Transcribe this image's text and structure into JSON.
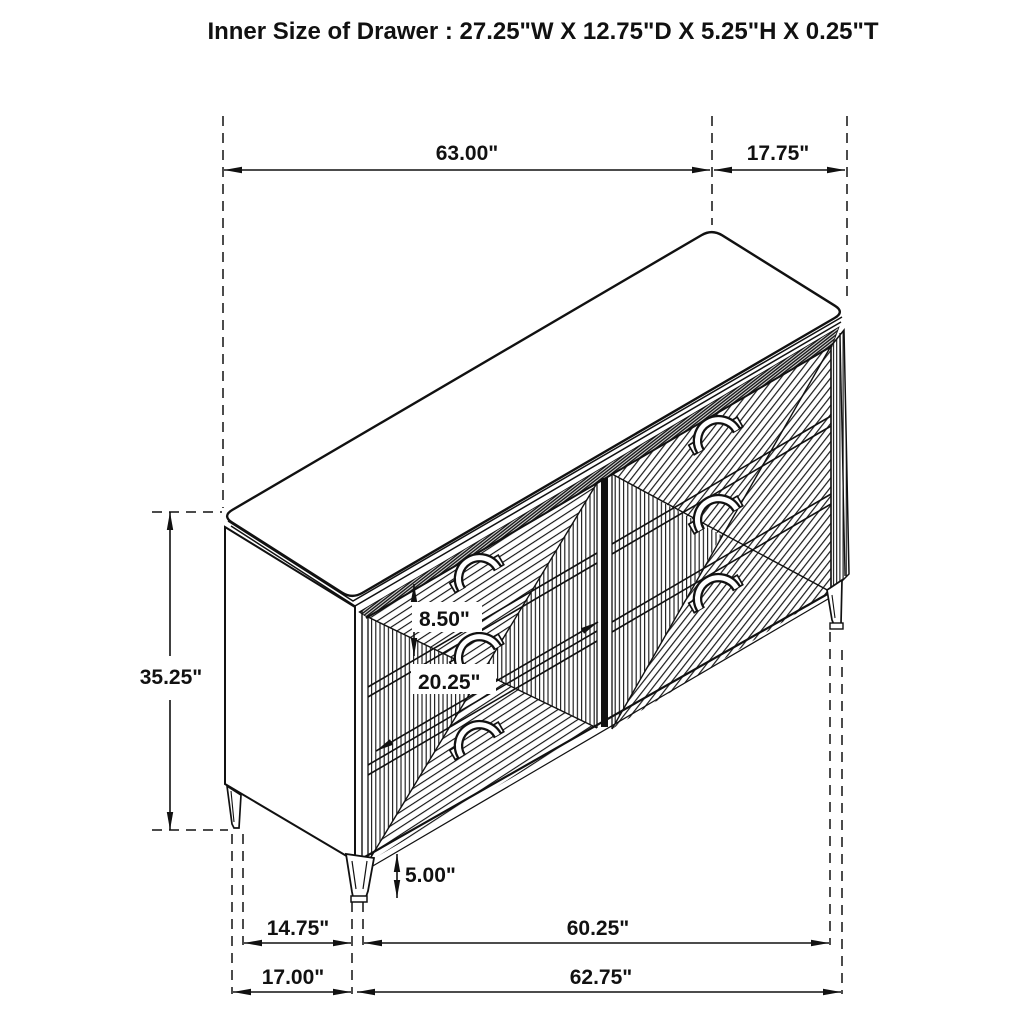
{
  "title": "Inner Size of Drawer : 27.25\"W X 12.75\"D X 5.25\"H X 0.25\"T",
  "dimensions": {
    "top_length": "63.00\"",
    "top_depth": "17.75\"",
    "overall_height": "35.25\"",
    "top_drawer_height": "8.50\"",
    "drawer_front_width": "20.25\"",
    "leg_height": "5.00\"",
    "base_depth_between_legs": "14.75\"",
    "base_depth_overall": "17.00\"",
    "base_width_between_legs": "60.25\"",
    "base_width_overall": "62.75\""
  },
  "colors": {
    "line": "#111111",
    "background": "#ffffff"
  }
}
